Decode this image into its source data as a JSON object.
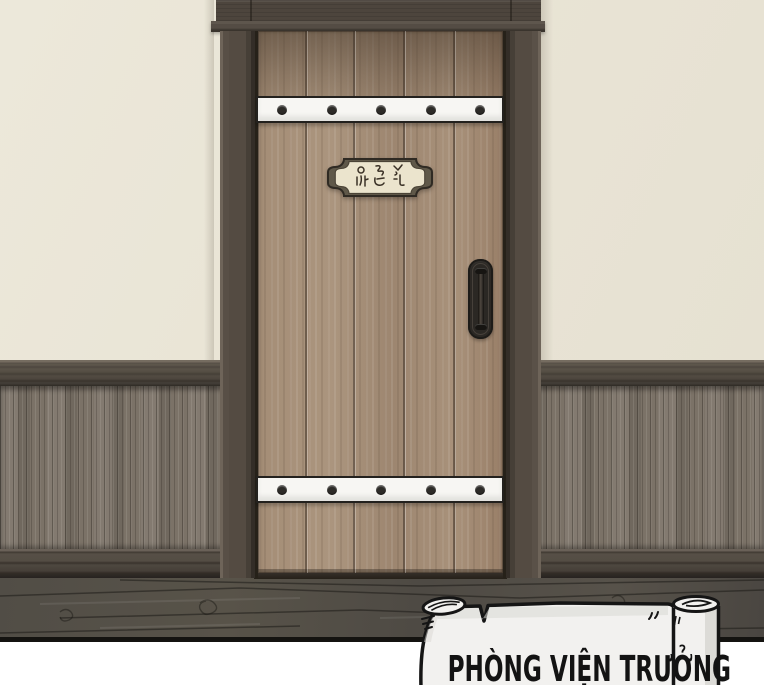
{
  "panel": {
    "type": "comic-panel",
    "setting": "hallway interior with a wooden plank door, wainscoted wall and dark wood floor"
  },
  "door": {
    "plate_text": "원장실",
    "plank_count": 5,
    "straps": 2,
    "rivets_per_strap": 5
  },
  "caption": {
    "label": "PHÒNG VIỆN TRƯỞNG"
  },
  "colors": {
    "wall": "#e9e4d5",
    "door_wood": "#a28b74",
    "door_frame": "#4d453d",
    "wainscot": "#7b7267",
    "baseboard": "#4a443d",
    "floor": "#54504a",
    "strap": "#f7f6f3",
    "plate_face": "#ebe4cd",
    "scroll_paper": "#f2f1ef",
    "ink": "#151515"
  }
}
